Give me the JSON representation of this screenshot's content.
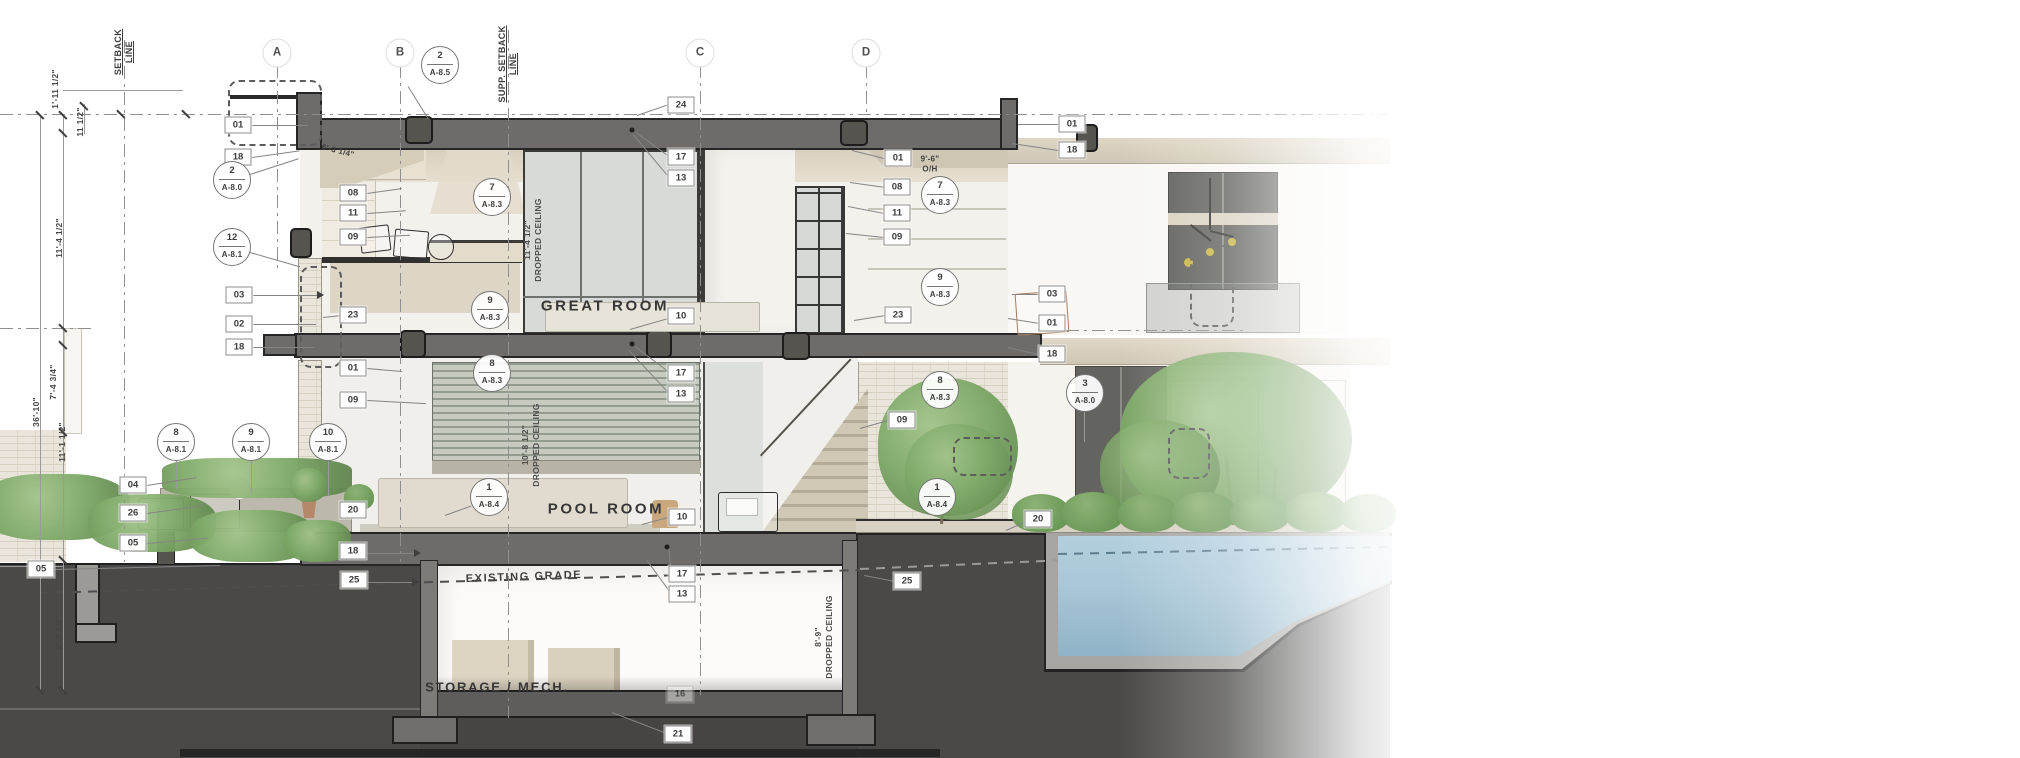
{
  "drawing": {
    "room_labels": [
      {
        "text": "GREAT ROOM",
        "x": 605,
        "y": 306,
        "size": "lg"
      },
      {
        "text": "POOL ROOM",
        "x": 606,
        "y": 509,
        "size": "lg"
      },
      {
        "text": "STORAGE / MECH.",
        "x": 497,
        "y": 687,
        "size": "sm"
      }
    ],
    "grid_axes": [
      {
        "label": "A",
        "x": 277,
        "line_bottom": 273
      },
      {
        "label": "B",
        "x": 400,
        "line_bottom": 562
      },
      {
        "label": "C",
        "x": 700,
        "line_bottom": 695
      },
      {
        "label": "D",
        "x": 866,
        "line_bottom": 114
      }
    ],
    "setback_lines": [
      {
        "label": "SETBACK\nLINE",
        "x": 124,
        "text_y": 52,
        "y1": 40,
        "y2": 562
      },
      {
        "label": "SUPP. SETBACK\nLINE",
        "x": 508,
        "text_y": 64,
        "y1": 30,
        "y2": 718
      }
    ],
    "dimensions": [
      {
        "text": "1'-11 1/2\"",
        "x": 55,
        "y": 89
      },
      {
        "text": "11 1/2\"",
        "x": 80,
        "y": 122
      },
      {
        "text": "11'-4 1/2\"",
        "x": 59,
        "y": 238
      },
      {
        "text": "7'-4 3/4\"",
        "x": 53,
        "y": 382
      },
      {
        "text": "36'-10\"",
        "x": 36,
        "y": 412
      },
      {
        "text": "11'-1 1/2\"",
        "x": 62,
        "y": 442
      },
      {
        "text": "9'-7 1/2\"",
        "x": 59,
        "y": 632
      }
    ],
    "ceiling_notes": [
      {
        "text": "11'-4 1/2\"\nDROPPED CEILING",
        "x": 533,
        "y": 240
      },
      {
        "text": "10'-8 1/2\"\nDROPPED CEILING",
        "x": 531,
        "y": 445
      },
      {
        "text": "8'-9\"\nDROPPED CEILING",
        "x": 824,
        "y": 637
      }
    ],
    "annotations": [
      {
        "text": "EXISTING GRADE",
        "x": 524,
        "y": 577,
        "rot": -2,
        "cls": "grade"
      },
      {
        "text": "9'-6\"\nO/H",
        "x": 930,
        "y": 164,
        "rot": 0,
        "cls": "small"
      },
      {
        "text": "6'-3 1/4\"",
        "x": 338,
        "y": 151,
        "rot": 14,
        "cls": "small"
      }
    ],
    "ref_tags": [
      {
        "t": "01",
        "x": 238,
        "y": 125
      },
      {
        "t": "18",
        "x": 238,
        "y": 157
      },
      {
        "t": "03",
        "x": 239,
        "y": 295
      },
      {
        "t": "02",
        "x": 239,
        "y": 324
      },
      {
        "t": "18",
        "x": 239,
        "y": 347
      },
      {
        "t": "04",
        "x": 133,
        "y": 485
      },
      {
        "t": "26",
        "x": 133,
        "y": 513
      },
      {
        "t": "05",
        "x": 133,
        "y": 543
      },
      {
        "t": "05",
        "x": 41,
        "y": 569
      },
      {
        "t": "08",
        "x": 353,
        "y": 193
      },
      {
        "t": "11",
        "x": 353,
        "y": 213
      },
      {
        "t": "09",
        "x": 353,
        "y": 237
      },
      {
        "t": "23",
        "x": 353,
        "y": 315
      },
      {
        "t": "01",
        "x": 353,
        "y": 368
      },
      {
        "t": "09",
        "x": 353,
        "y": 400
      },
      {
        "t": "20",
        "x": 353,
        "y": 510
      },
      {
        "t": "18",
        "x": 353,
        "y": 551
      },
      {
        "t": "25",
        "x": 354,
        "y": 580
      },
      {
        "t": "24",
        "x": 681,
        "y": 105
      },
      {
        "t": "17",
        "x": 681,
        "y": 157
      },
      {
        "t": "13",
        "x": 681,
        "y": 178
      },
      {
        "t": "10",
        "x": 681,
        "y": 316
      },
      {
        "t": "17",
        "x": 681,
        "y": 373
      },
      {
        "t": "13",
        "x": 681,
        "y": 394
      },
      {
        "t": "10",
        "x": 682,
        "y": 517
      },
      {
        "t": "17",
        "x": 682,
        "y": 574
      },
      {
        "t": "13",
        "x": 682,
        "y": 594
      },
      {
        "t": "16",
        "x": 680,
        "y": 694,
        "faded": true
      },
      {
        "t": "21",
        "x": 678,
        "y": 734
      },
      {
        "t": "01",
        "x": 898,
        "y": 158
      },
      {
        "t": "08",
        "x": 897,
        "y": 187
      },
      {
        "t": "11",
        "x": 897,
        "y": 213
      },
      {
        "t": "09",
        "x": 897,
        "y": 237
      },
      {
        "t": "23",
        "x": 898,
        "y": 315
      },
      {
        "t": "09",
        "x": 902,
        "y": 420
      },
      {
        "t": "25",
        "x": 907,
        "y": 581
      },
      {
        "t": "03",
        "x": 1052,
        "y": 294
      },
      {
        "t": "01",
        "x": 1052,
        "y": 323
      },
      {
        "t": "18",
        "x": 1052,
        "y": 354
      },
      {
        "t": "20",
        "x": 1038,
        "y": 519
      },
      {
        "t": "01",
        "x": 1072,
        "y": 124
      },
      {
        "t": "18",
        "x": 1072,
        "y": 150
      }
    ],
    "detail_callouts": [
      {
        "n": "2",
        "s": "A-8.5",
        "x": 440,
        "y": 65
      },
      {
        "n": "2",
        "s": "A-8.0",
        "x": 232,
        "y": 180
      },
      {
        "n": "12",
        "s": "A-8.1",
        "x": 232,
        "y": 247
      },
      {
        "n": "7",
        "s": "A-8.3",
        "x": 492,
        "y": 197
      },
      {
        "n": "9",
        "s": "A-8.3",
        "x": 490,
        "y": 310
      },
      {
        "n": "8",
        "s": "A-8.3",
        "x": 492,
        "y": 373
      },
      {
        "n": "1",
        "s": "A-8.4",
        "x": 489,
        "y": 497
      },
      {
        "n": "8",
        "s": "A-8.1",
        "x": 176,
        "y": 442
      },
      {
        "n": "9",
        "s": "A-8.1",
        "x": 251,
        "y": 442
      },
      {
        "n": "10",
        "s": "A-8.1",
        "x": 328,
        "y": 442
      },
      {
        "n": "7",
        "s": "A-8.3",
        "x": 940,
        "y": 195
      },
      {
        "n": "9",
        "s": "A-8.3",
        "x": 940,
        "y": 287
      },
      {
        "n": "8",
        "s": "A-8.3",
        "x": 940,
        "y": 390
      },
      {
        "n": "1",
        "s": "A-8.4",
        "x": 937,
        "y": 497
      },
      {
        "n": "3",
        "s": "A-8.0",
        "x": 1085,
        "y": 393
      }
    ],
    "colors": {
      "cut_poche": "#6e6c6a",
      "earth": "#4a4948",
      "water": "#a9c7d9",
      "foliage": "#7da967",
      "fascia_cream": "#d6cebd",
      "stone": "#e9e5da",
      "tag_border": "#8d8d8d",
      "line_gray": "#8f8f8f",
      "text_dark": "#3c3c3c"
    }
  }
}
